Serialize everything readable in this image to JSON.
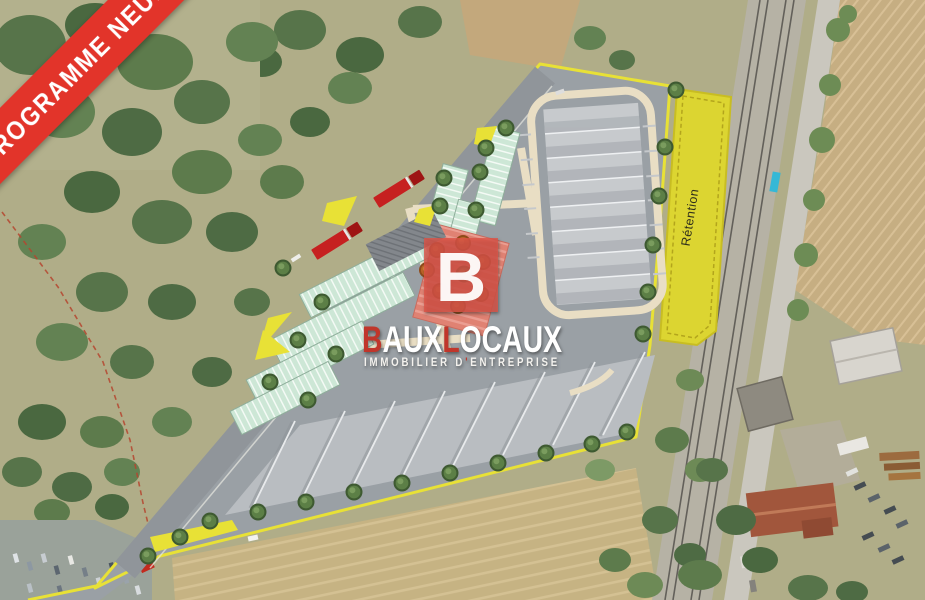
{
  "ribbon": {
    "label": "PROGRAMME NEUF"
  },
  "brand": {
    "monogram": "B",
    "wordmark": {
      "seg1": "B",
      "seg2": "AUX",
      "seg3": "L",
      "seg4": "OCAUX"
    },
    "tagline": {
      "text": "IMMOBILIER D'ENTREPRISE",
      "part1": "IMMOBILIER D",
      "apostrophe": "'",
      "part2": "ENTREPRISE"
    }
  },
  "plan": {
    "retention_label": "Rétention"
  },
  "colors": {
    "ribbon_red": "#e2342a",
    "ribbon_text": "#ffffff",
    "brand_square": "#dd5447",
    "brand_red": "#c0362b",
    "brand_white": "#ffffff",
    "site_outline_yellow": "#e8e136",
    "retention_yellow": "#dcd531",
    "asphalt_gray": "#9aa0a5",
    "parking_mint": "#cde7d6",
    "courtyard_pink": "#e08273",
    "road_beige": "#e9dec4",
    "truck_red": "#c62020"
  }
}
